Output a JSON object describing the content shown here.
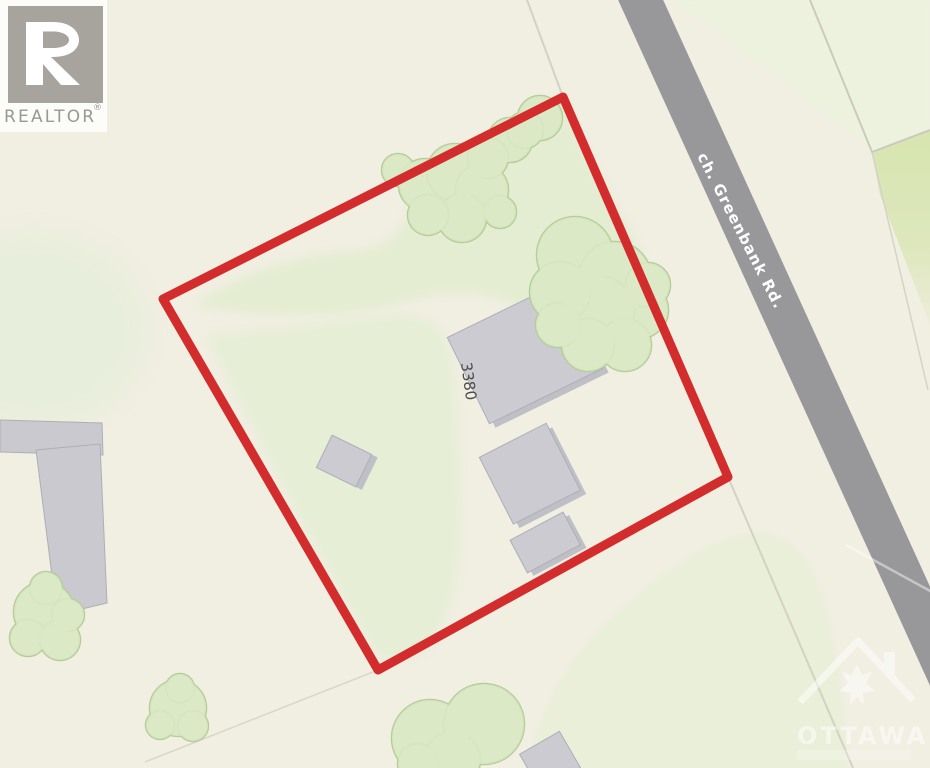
{
  "branding": {
    "realtor_logo_text": "REALTOR",
    "registered_mark": "®"
  },
  "road": {
    "name": "ch. Greenbank Rd."
  },
  "property": {
    "house_number": "3380",
    "boundary_color": "#d22c2c"
  },
  "watermark": {
    "city": "OTTAWA"
  },
  "colors": {
    "background": "#f1eee2",
    "road": "#98989b",
    "road_label": "#ffffff",
    "building_fill": "#cbcbd1",
    "building_stroke": "#aeaeb6",
    "building_shadow": "#bfbfc6",
    "tree_fill": "#dbe9c5",
    "tree_edge": "#b5cd97",
    "green_light": "#e9efd8",
    "green_mid": "#d7e5b0",
    "lot_line": "#d4d1c5",
    "house_number_text": "#4b4b4b",
    "logo_square": "#a7a39d",
    "logo_text": "#9b9792"
  }
}
